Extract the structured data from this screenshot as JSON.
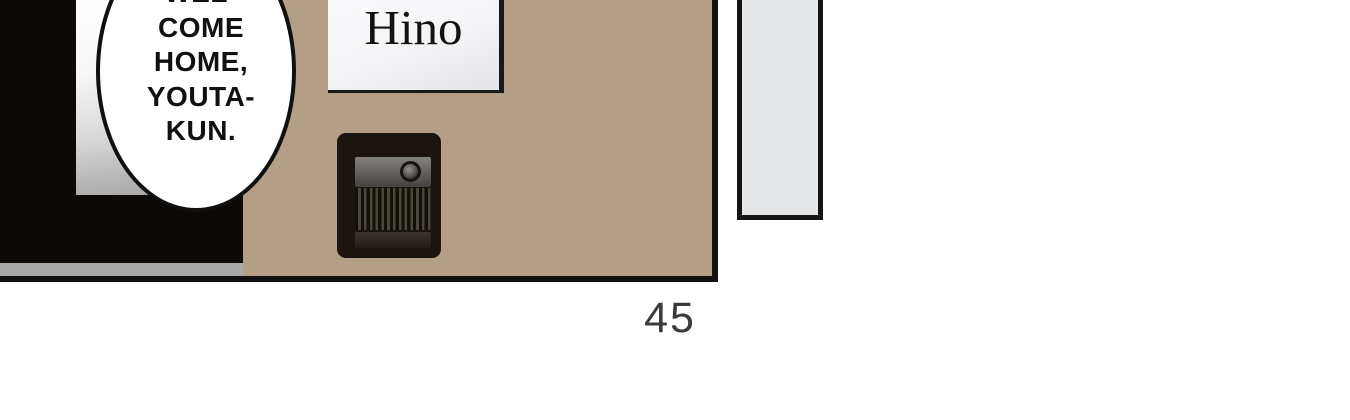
{
  "page": {
    "number_label": "45",
    "background_color": "#ffffff"
  },
  "panel": {
    "wall_color": "#b49e86",
    "outline_color": "#111111",
    "dark_interior_color": "#0c0906",
    "floor_strip_color": "#a9a9a9",
    "door_gradient_top": "#ffffff",
    "door_gradient_bottom": "#a9a9a9"
  },
  "speech_bubble": {
    "lines": [
      "WEL-",
      "COME",
      "HOME,",
      "YOUTA-",
      "KUN."
    ],
    "fill_color": "#ffffff",
    "stroke_color": "#101010",
    "text_color": "#111111"
  },
  "nameplate": {
    "name": "Hino",
    "fill_color": "#f3f3f5",
    "border_color": "#191919",
    "text_color": "#121212"
  },
  "intercom": {
    "body_color": "#1b140f",
    "top_panel_color": "#6b6965",
    "button_color": "#55524e",
    "grille_dark_color": "#131008",
    "grille_light_color": "#4a453d"
  },
  "right_panel": {
    "fill_color": "#e4e6e8",
    "border_color": "#141414"
  }
}
